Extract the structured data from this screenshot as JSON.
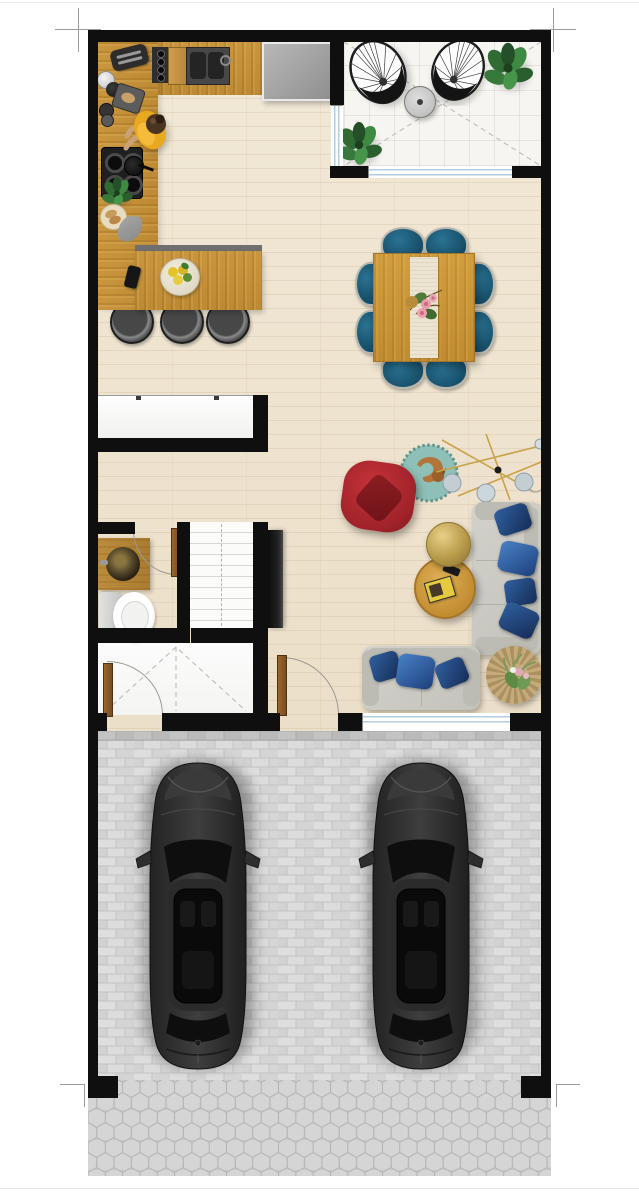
{
  "document": {
    "kind": "residential floor plan, top-down 2D render on white sheet",
    "visible_text": [],
    "sheet": {
      "trim_marks": 4,
      "background": "#ffffff"
    }
  },
  "semantic_labels": {
    "balcony": "Tiled balcony with two wicker egg chairs, side table and plants",
    "kitchen": "Kitchen with L-shaped counter, cooktop, sink, fridge and breakfast bar",
    "dining": "Dining area with wooden table, runner, flowers and 8 blue chairs",
    "living": "Living room with red armchair, grey sofas, blue pillows, coffee tables and floor lamp",
    "hallway": "Hallway",
    "wardrobe": "Built-in wardrobe with sliding doors",
    "bathroom": "Bathroom with wooden vanity, vessel sink and toilet",
    "stairs": "Staircase",
    "storage": "Storage / utility room",
    "garage": "Double garage with two dark cars on brick paving",
    "apron": "Hexagonal-paver driveway apron",
    "person": "Person cooking at the stove",
    "dog": "Dog lying on round rug"
  },
  "counts": {
    "dining_chairs": 8,
    "bar_stools": 3,
    "cars": 2,
    "sofas": 2,
    "sofa_pillows": 7,
    "balcony_chairs": 2,
    "plants": 4,
    "interior_doors_shown": 3
  },
  "palette": {
    "wall": "#0f0f0f",
    "wood_floor": "#efe5d2",
    "counter_wood": "#c9963f",
    "balcony_tile": "#f6f5f1",
    "dining_chair_blue": "#1d5a78",
    "pillow_navy": "#1f3f7c",
    "armchair_red": "#b3282e",
    "sofa_grey": "#cdccc5",
    "rug_teal": "#8fc0b7",
    "brass_gold": "#c3a853",
    "garage_brick": "#d7d7d7",
    "hex_paver": "#cfcfcf",
    "window_glass": "#b3cde2",
    "car_body": "#2e2e2e"
  },
  "furniture": {
    "balcony": [
      "egg-chair",
      "egg-chair",
      "round-side-table",
      "monstera-plant",
      "monstera-plant"
    ],
    "kitchen": [
      "toaster",
      "kettle-set",
      "cutting-board",
      "espresso-pot",
      "cooktop-4-burner",
      "sink-double",
      "fridge",
      "herb-plant",
      "bread-plate",
      "napkin",
      "phone",
      "fruit-bowl",
      "bar-stool x3"
    ],
    "dining": [
      "square-wood-table",
      "table-runner",
      "flower-centerpiece",
      "chair x8"
    ],
    "living": [
      "red-armchair",
      "round-rug-with-dog",
      "sputnik-floor-lamp",
      "wall-tv",
      "gold-round-table",
      "wood-coffee-table",
      "magazines",
      "remote",
      "sofa-3seat-vertical",
      "sofa-2seat-horizontal",
      "navy-pillow x7",
      "basket-planter"
    ],
    "bathroom": [
      "wood-vanity",
      "brass-vessel-sink",
      "toilet"
    ],
    "garage": [
      "car",
      "car"
    ]
  }
}
